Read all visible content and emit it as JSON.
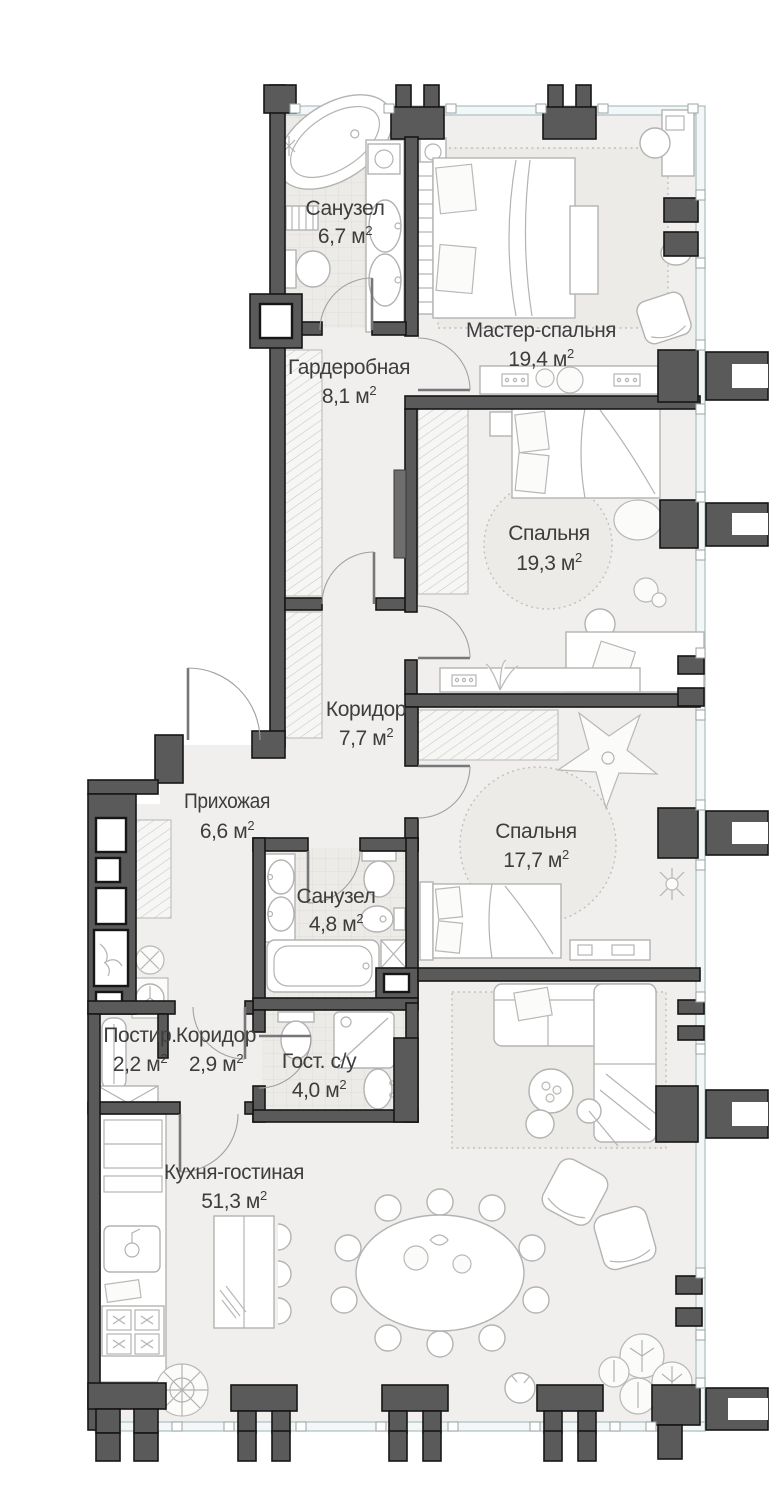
{
  "plan": {
    "title": "Apartment floor plan",
    "sup": "2",
    "rooms": [
      {
        "id": "bathroom-master",
        "label": "Санузел",
        "area": "6,7",
        "area_label": "6,7 м"
      },
      {
        "id": "master-bedroom",
        "label": "Мастер-спальня",
        "area": "19,4",
        "area_label": "19,4 м"
      },
      {
        "id": "wardrobe",
        "label": "Гардеробная",
        "area": "8,1",
        "area_label": "8,1 м"
      },
      {
        "id": "bedroom-2",
        "label": "Спальня",
        "area": "19,3",
        "area_label": "19,3 м"
      },
      {
        "id": "corridor",
        "label": "Коридор",
        "area": "7,7",
        "area_label": "7,7 м"
      },
      {
        "id": "hallway",
        "label": "Прихожая",
        "area": "6,6",
        "area_label": "6,6 м"
      },
      {
        "id": "bedroom-3",
        "label": "Спальня",
        "area": "17,7",
        "area_label": "17,7 м"
      },
      {
        "id": "bathroom-2",
        "label": "Санузел",
        "area": "4,8",
        "area_label": "4,8 м"
      },
      {
        "id": "laundry",
        "label": "Постир.",
        "area": "2,2",
        "area_label": "2,2 м"
      },
      {
        "id": "corridor-2",
        "label": "Коридор",
        "area": "2,9",
        "area_label": "2,9 м"
      },
      {
        "id": "guest-wc",
        "label": "Гост. с/у",
        "area": "4,0",
        "area_label": "4,0 м"
      },
      {
        "id": "kitchen-living",
        "label": "Кухня-гостиная",
        "area": "51,3",
        "area_label": "51,3 м"
      }
    ],
    "colors": {
      "wall": "#5a5a5a",
      "wall_outline": "#161616",
      "floor": "#f0efed",
      "tile": "#edebe8",
      "glass": "#aabfc2",
      "furniture_stroke": "#b3b3b1",
      "rug": "#ecebe8",
      "text": "#3d3d3d"
    }
  }
}
